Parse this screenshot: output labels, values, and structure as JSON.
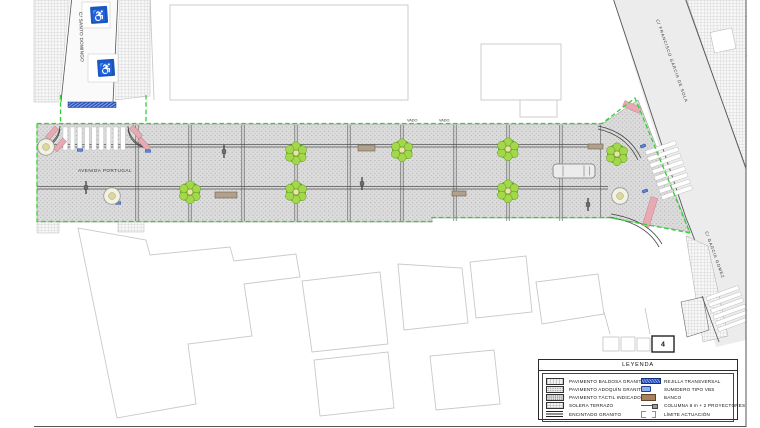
{
  "streets": {
    "avenue": "AVENIDA PORTUGAL",
    "north": "C/ SANTO DOMINGO",
    "diagonal": "C/ FRANCISCO GARCIA DE SOLA",
    "southeast": "C/ GARCIA GOMEZ"
  },
  "annotations": {
    "vado": "VADO",
    "detail_number": "4"
  },
  "icons": {
    "handicap": "♿"
  },
  "legend": {
    "title": "LEYENDA",
    "left_column": [
      {
        "label": "PAVIMENTO BALDOSA GRANITO",
        "swatch": "baldosa"
      },
      {
        "label": "PAVIMENTO ADOQUÍN GRANITO",
        "swatch": "adoquin"
      },
      {
        "label": "PAVIMENTO TÁCTIL INDICADOR",
        "swatch": "tactil"
      },
      {
        "label": "SOLERA TERRAZO",
        "swatch": "solera"
      },
      {
        "label": "ENCINTADO GRANITO",
        "swatch": "encintado"
      }
    ],
    "right_column": [
      {
        "label": "REJILLA TRANSVERSAL",
        "swatch": "rejilla"
      },
      {
        "label": "SUMIDERO TIPO VBS",
        "swatch": "sumidero"
      },
      {
        "label": "BANCO",
        "swatch": "banco"
      },
      {
        "label": "COLUMNA 8 m + 2 PROYECTORES",
        "swatch": "columna"
      },
      {
        "label": "LÍMITE ACTUACIÓN",
        "swatch": "limite"
      }
    ]
  },
  "colors": {
    "boundary_green": "#2fd32f",
    "tree_green": "#7fbf2f",
    "handicap_blue": "#1a56c4",
    "ramp_pink": "#e8aab2",
    "bench_brown": "#a9825d",
    "grille_blue": "#2a52be",
    "pavement_gray": "#dcdcdc"
  }
}
